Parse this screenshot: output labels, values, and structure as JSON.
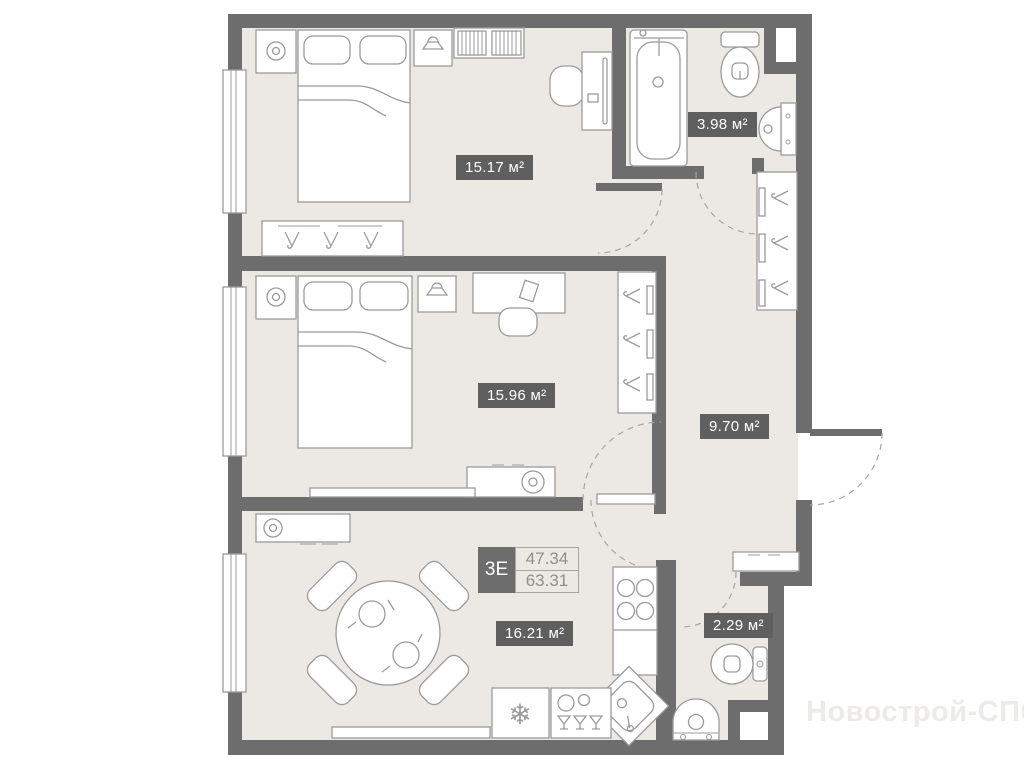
{
  "plan": {
    "type_label": "3Е",
    "area_living": "47.34",
    "area_total": "63.31",
    "rooms": [
      {
        "id": "bedroom-1",
        "area": "15.17 м²"
      },
      {
        "id": "bathroom",
        "area": "3.98 м²"
      },
      {
        "id": "bedroom-2",
        "area": "15.96 м²"
      },
      {
        "id": "hallway",
        "area": "9.70 м²"
      },
      {
        "id": "kitchen-living",
        "area": "16.21 м²"
      },
      {
        "id": "wc",
        "area": "2.29 м²"
      }
    ],
    "watermark": "Новострой-СПб",
    "colors": {
      "wall": "#6d6d6d",
      "floor": "#ece8e4",
      "furniture_line": "#9b9b9b",
      "badge_bg": "#5f5f5f",
      "badge_text": "#ffffff",
      "value_text": "#8f8f8f",
      "watermark": "#edebe8"
    }
  }
}
